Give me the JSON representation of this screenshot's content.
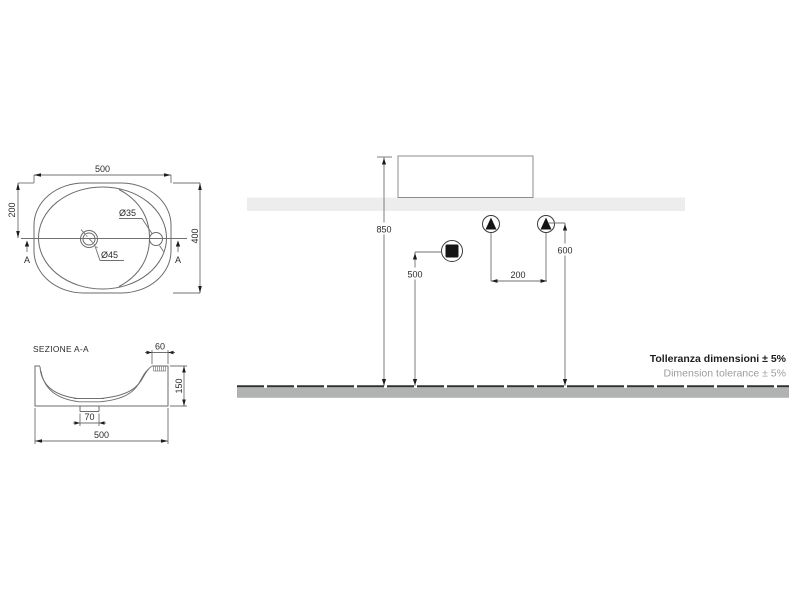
{
  "drawing": {
    "top_view": {
      "width_dim": "500",
      "center_offset_dim": "200",
      "depth_dim": "400",
      "tap_hole_dim": "Ø35",
      "drain_dim": "Ø45",
      "section_marker": "A"
    },
    "section_view": {
      "title": "SEZIONE A-A",
      "ledge_dim": "60",
      "height_dim": "150",
      "drain_width_dim": "70",
      "width_dim": "500"
    },
    "installation_view": {
      "rim_height_dim": "850",
      "drain_outlet_height_dim": "500",
      "supply_height_dim": "600",
      "supply_spacing_dim": "200",
      "symbols": {
        "drain_outlet": "drain-outlet",
        "water_supply": "water-supply"
      }
    },
    "notes": {
      "tolerance_primary": "Tolleranza dimensioni ± 5%",
      "tolerance_secondary": "Dimension tolerance ± 5%"
    },
    "colors": {
      "line": "#6a6b6d",
      "dim_line": "#6f7072",
      "text": "#2a2a2a",
      "note_primary": "#1d1d1b",
      "note_secondary": "#9c9c9c",
      "shelf_fill": "#ededed",
      "floor_fill": "#b0b3b1",
      "symbol_fill": "#141414"
    }
  }
}
